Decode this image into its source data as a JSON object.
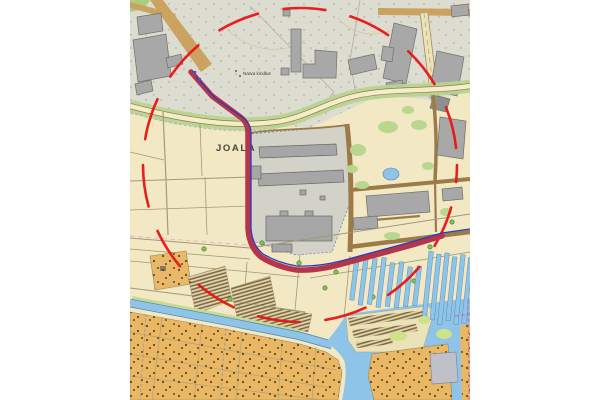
{
  "map": {
    "labels": {
      "district": "JOALA",
      "poi": "Narva kindlus"
    },
    "overlays": {
      "highlight_circle_color": "#e81414",
      "route_color": "#b5364a",
      "route_waterline_color": "#2a3bbf"
    },
    "palette": {
      "parcel_cream": "#f2e8c4",
      "industrial_gray": "#dddcd0",
      "building_gray": "#a8a8a8",
      "water_blue": "#8ec4e8",
      "allotment_orange": "#eab864",
      "vegetation_green": "#b7d38e",
      "road_brown": "#9c7b49"
    }
  }
}
